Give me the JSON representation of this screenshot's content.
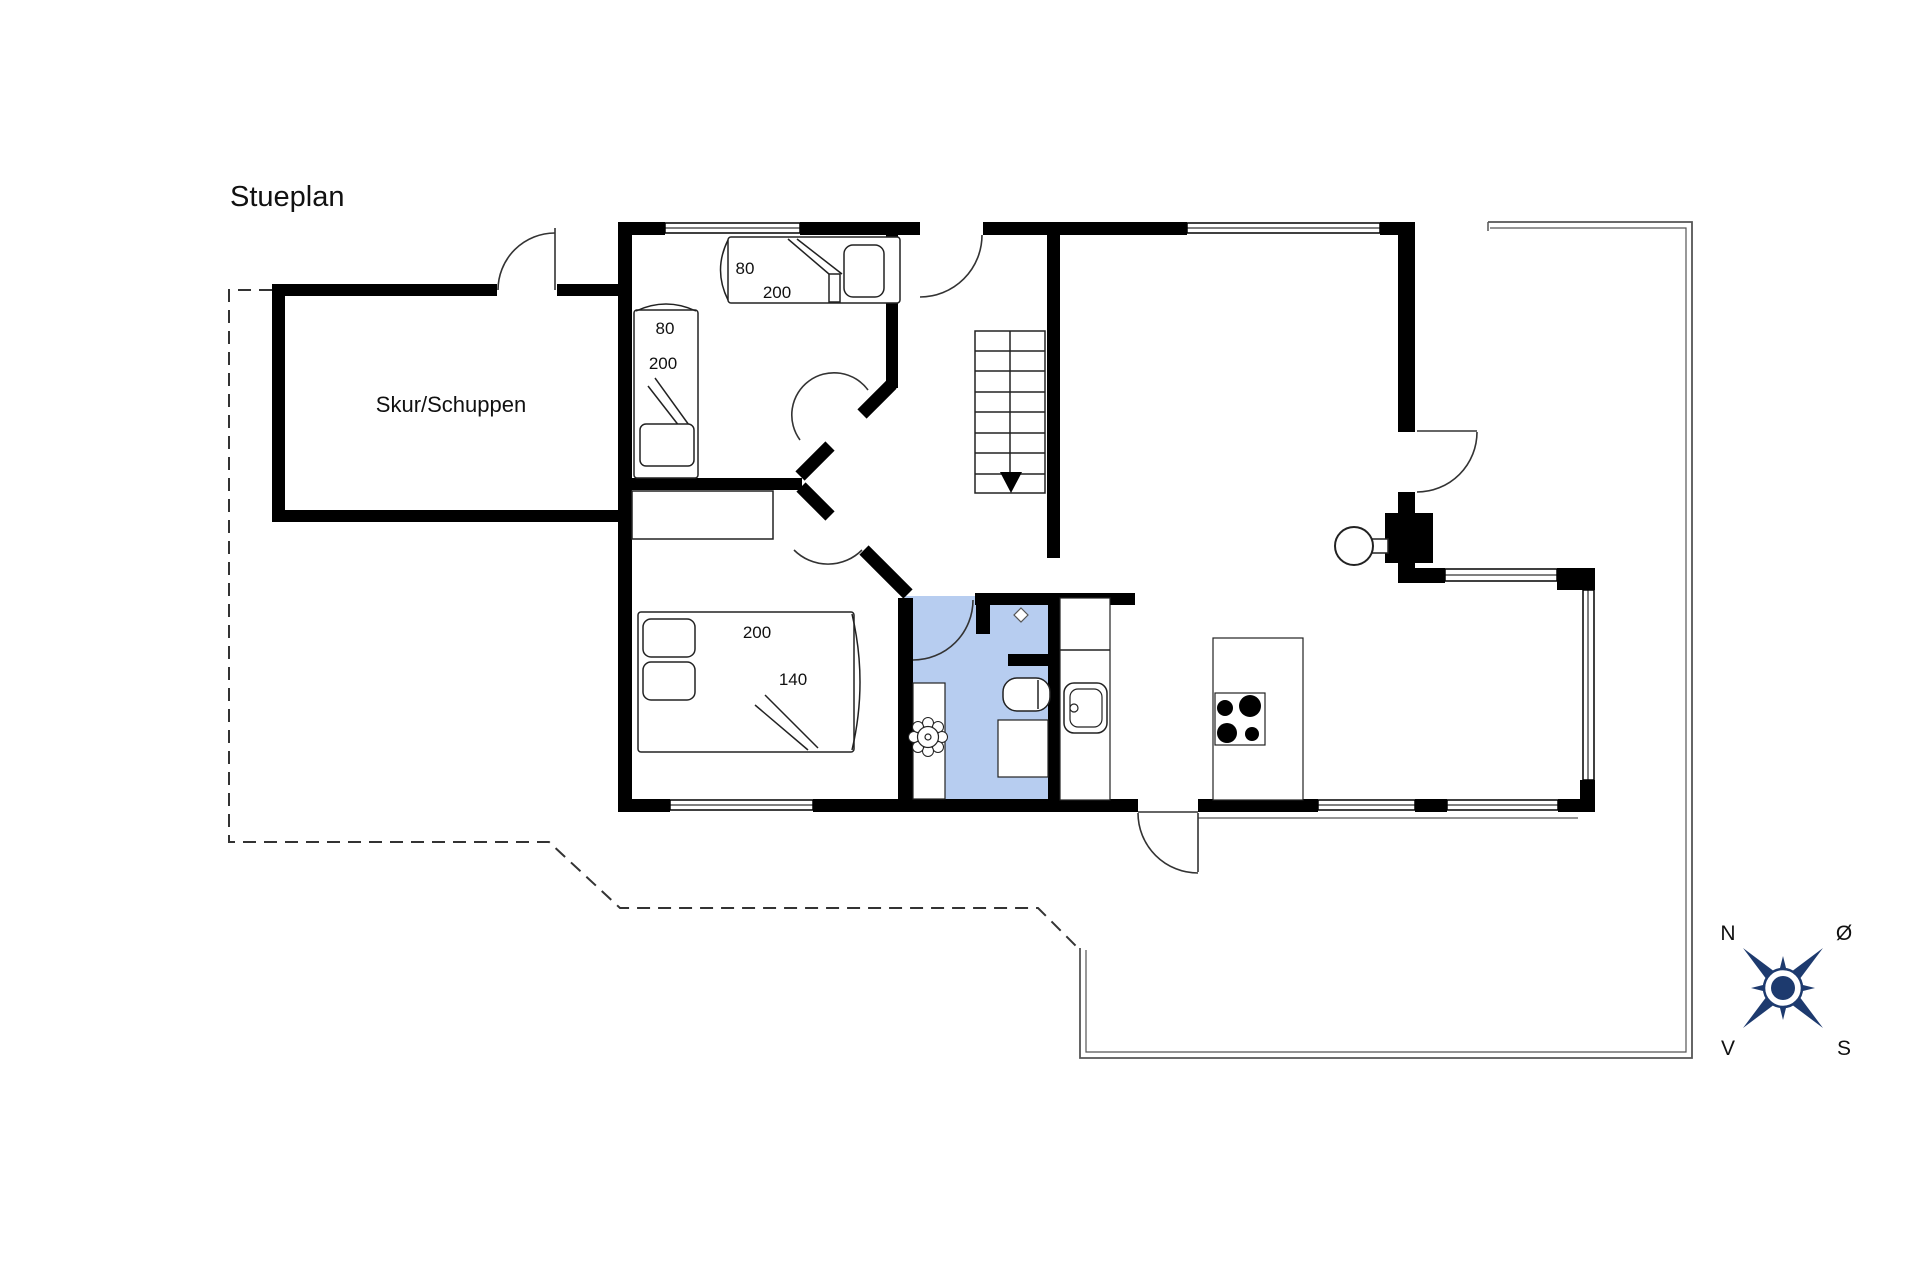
{
  "title": "Stueplan",
  "shed_label": "Skur/Schuppen",
  "beds": {
    "single_top": {
      "width": "80",
      "length": "200"
    },
    "single_left": {
      "width": "80",
      "length": "200"
    },
    "double": {
      "length": "200",
      "width": "140"
    }
  },
  "compass": {
    "n": "N",
    "e": "Ø",
    "s": "S",
    "v": "V"
  },
  "colors": {
    "wall": "#000000",
    "bath": "#b7cdf0",
    "compass": "#1d3a6e"
  }
}
